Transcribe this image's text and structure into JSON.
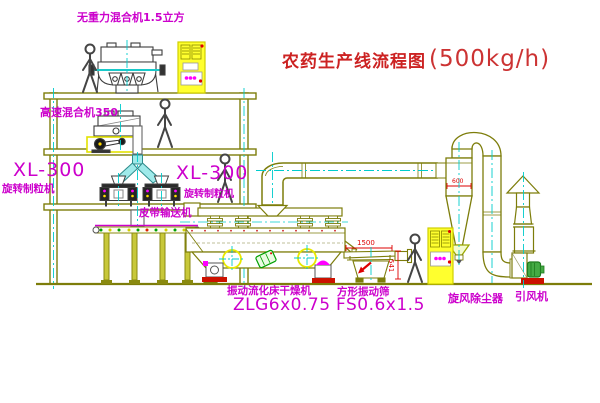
{
  "diagram": {
    "title_text": "农药生产线流程图",
    "title_capacity": "(500kg/h)"
  },
  "labels": {
    "weightless_mixer": "无重力混合机1.5立方",
    "high_speed_mixer": "高速混合机350",
    "granulator_left_model": "XL-300",
    "granulator_left_name": "旋转制粒机",
    "granulator_right_model": "XL-300",
    "granulator_right_name": "旋转制粒机",
    "belt_conveyor": "皮带输送机",
    "dryer_name": "振动流化床干燥机",
    "dryer_model": "ZLG6x0.75",
    "sieve_name": "方形振动筛",
    "sieve_model": "FS0.6x1.5",
    "cyclone": "旋风除尘器",
    "fan": "引风机"
  },
  "dimensions": {
    "sieve_length": "1500",
    "sieve_side": "541",
    "cyclone_body": "600"
  },
  "colors": {
    "label_magenta": "#cc00cc",
    "title_red": "#cc2222",
    "structure_olive": "#7d7d0a",
    "centerline_cyan": "#00cccc",
    "cabinet_yellow": "#ffff2e",
    "accent_red": "#dd0000"
  }
}
